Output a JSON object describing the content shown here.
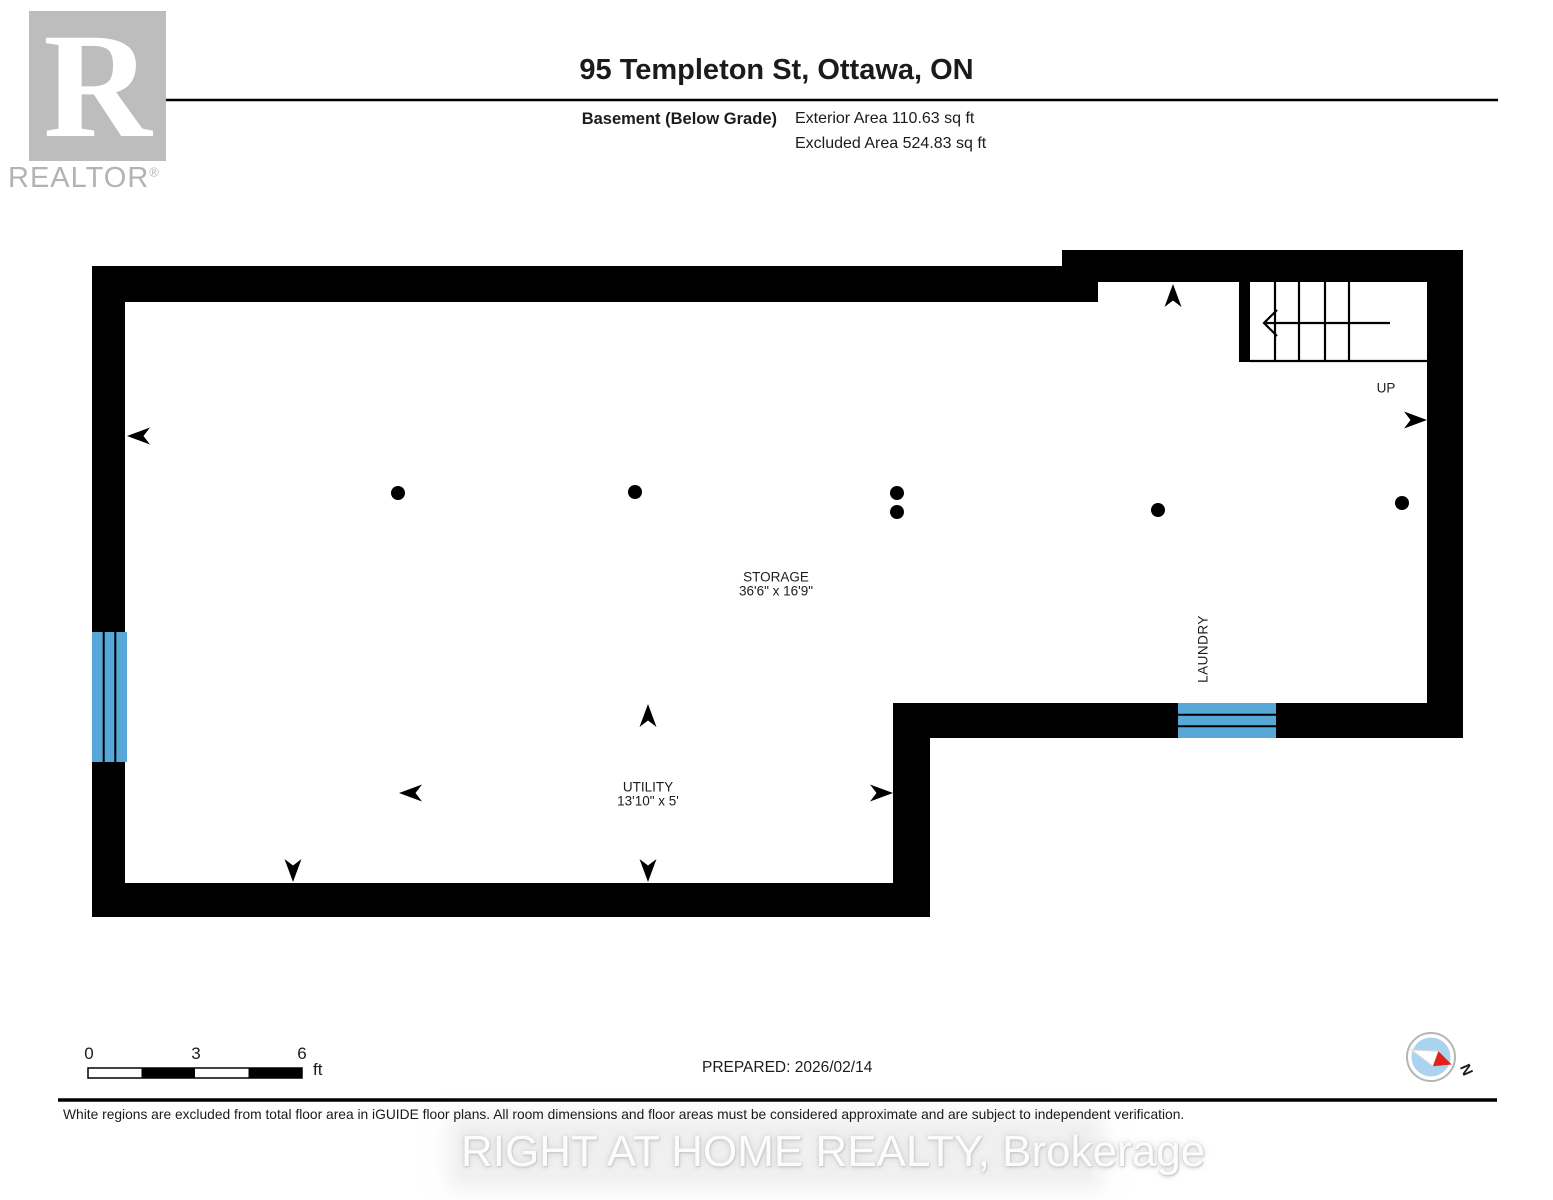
{
  "header": {
    "title": "95 Templeton St, Ottawa, ON",
    "floor_label": "Basement (Below Grade)",
    "exterior_area": "Exterior Area 110.63 sq ft",
    "excluded_area": "Excluded Area 524.83 sq ft"
  },
  "logo": {
    "letter": "R",
    "wordmark": "REALTOR",
    "registered": "®"
  },
  "rooms": {
    "storage": {
      "name": "STORAGE",
      "dims": "36'6\" x 16'9\""
    },
    "utility": {
      "name": "UTILITY",
      "dims": "13'10\" x 5'"
    },
    "laundry": {
      "name": "LAUNDRY"
    }
  },
  "stairs": {
    "up_label": "UP"
  },
  "scale_bar": {
    "tick0": "0",
    "tick1": "3",
    "tick2": "6",
    "unit": "ft"
  },
  "footer": {
    "prepared": "PREPARED: 2026/02/14",
    "disclaimer": "White regions are excluded from total floor area in iGUIDE floor plans. All room dimensions and floor areas must be considered approximate and are subject to independent verification.",
    "watermark": "RIGHT AT HOME REALTY, Brokerage"
  },
  "compass": {
    "north_label": "N"
  },
  "colors": {
    "wall": "#000000",
    "window": "#57a8d9",
    "logo_gray": "#bdbdbd",
    "wordmark_gray": "#b3b3b3",
    "compass_blue": "#a9d3ee",
    "needle_red": "#e32119"
  }
}
